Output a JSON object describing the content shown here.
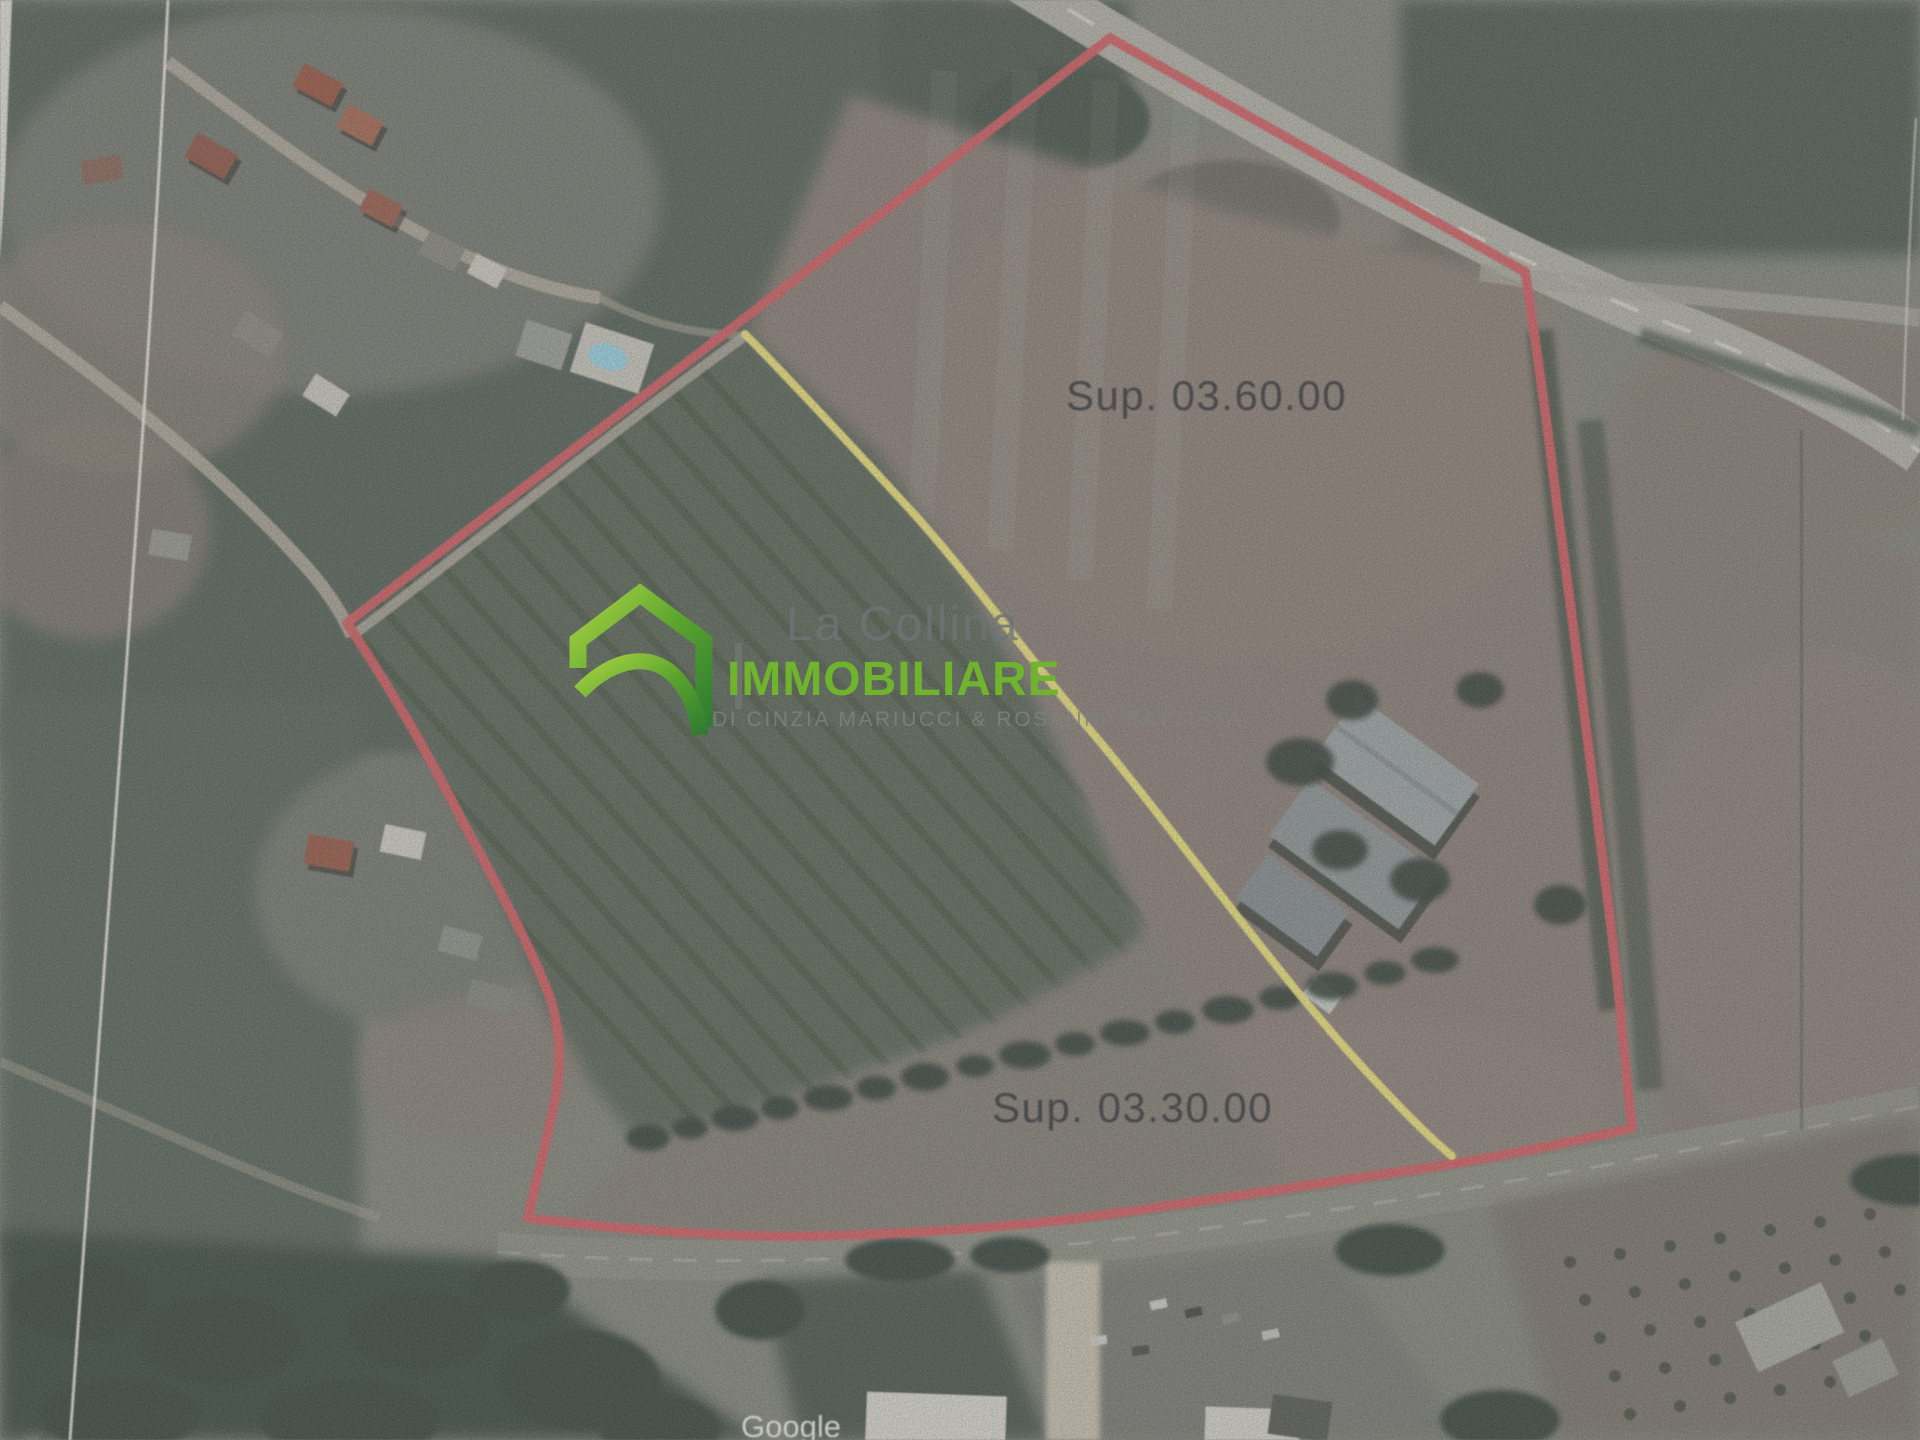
{
  "scan": {
    "description": "Scanned satellite photo with hand-marked land parcel boundaries",
    "labels": {
      "parcel_upper": "Sup. 03.60.00",
      "parcel_lower": "Sup. 03.30.00"
    },
    "google_watermark": "Google",
    "boundary_color": "#e25e62",
    "divider_color": "#ebdf68"
  },
  "logo": {
    "line1": "La Collina",
    "line2": "IMMOBILIARE",
    "tagline": "DI CINZIA MARIUCCI & ROSANNA BATTISTA",
    "brand_green": "#6fb42c",
    "icon": "house-arch-icon"
  }
}
